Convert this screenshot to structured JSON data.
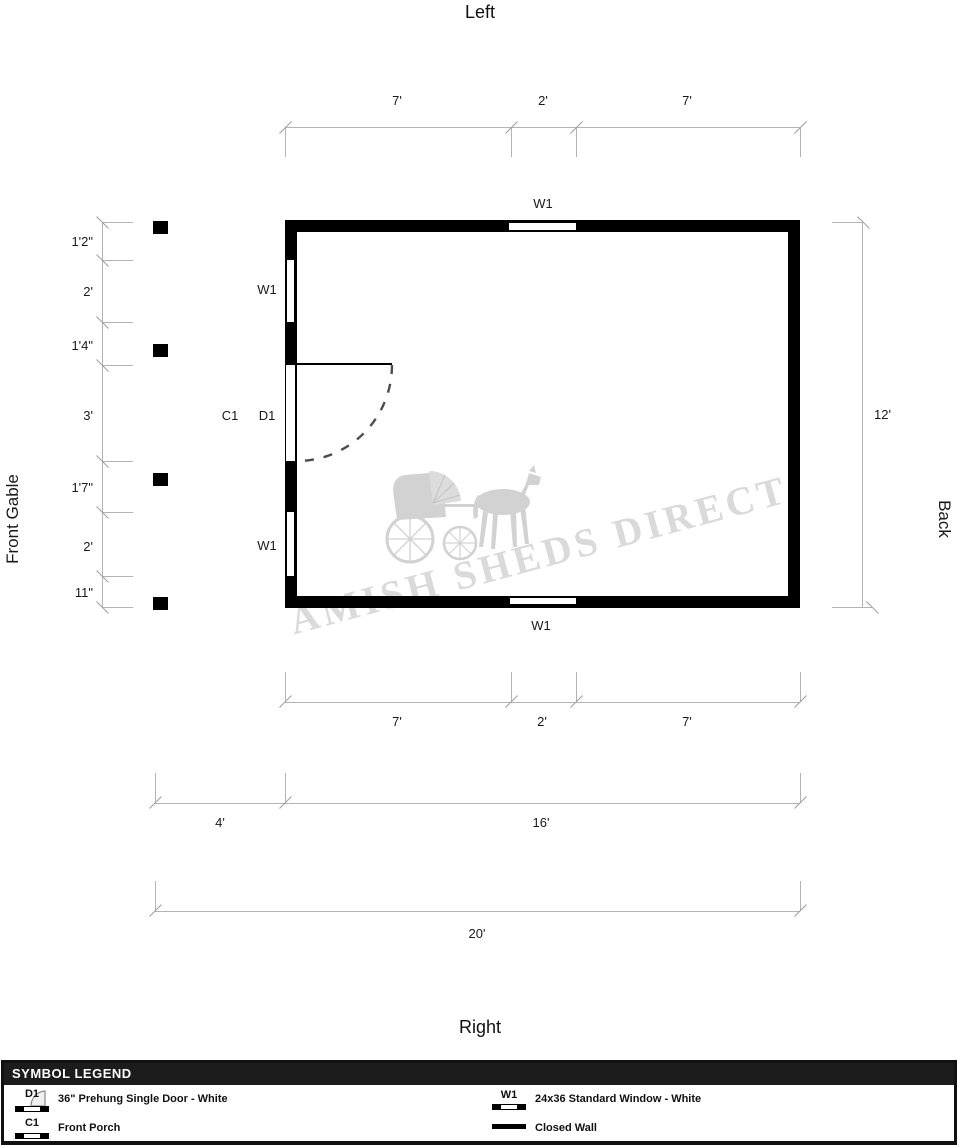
{
  "titles": {
    "top": "Left",
    "bottom": "Right",
    "left_side": "Front Gable",
    "right_side": "Back"
  },
  "watermark": {
    "text": "AMISH SHEDS DIRECT",
    "logo": "horse-and-buggy"
  },
  "plan": {
    "window_labels": {
      "top": "W1",
      "left_upper": "W1",
      "left_lower": "W1",
      "bottom": "W1"
    },
    "door_label": "D1",
    "porch_label": "C1"
  },
  "dims": {
    "top": [
      "7'",
      "2'",
      "7'"
    ],
    "left": [
      "1'2\"",
      "2'",
      "1'4\"",
      "3'",
      "1'7\"",
      "2'",
      "11\""
    ],
    "right": "12'",
    "bottom1": [
      "7'",
      "2'",
      "7'"
    ],
    "bottom2": [
      "4'",
      "16'"
    ],
    "bottom3": "20'"
  },
  "legend": {
    "header": "SYMBOL LEGEND",
    "items": [
      {
        "code": "D1",
        "label": "36\" Prehung Single Door - White"
      },
      {
        "code": "C1",
        "label": "Front Porch"
      },
      {
        "code": "W1",
        "label": "24x36 Standard Window - White"
      },
      {
        "code": "",
        "label": "Closed Wall"
      }
    ]
  },
  "colors": {
    "wall": "#000000",
    "dimension_line": "#b3b3b3",
    "watermark": "#dadada",
    "legend_header_bg": "#1c1c1c"
  }
}
